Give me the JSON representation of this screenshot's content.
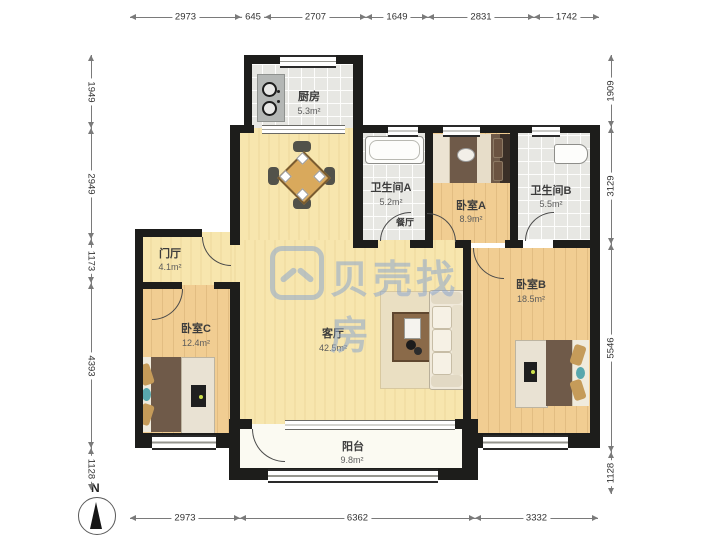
{
  "watermark": {
    "brand": "贝壳找房"
  },
  "compass": {
    "label": "N"
  },
  "rooms": {
    "kitchen": {
      "name": "厨房",
      "area": "5.3m²"
    },
    "bathroom_a": {
      "name": "卫生间A",
      "area": "5.2m²"
    },
    "bedroom_a": {
      "name": "卧室A",
      "area": "8.9m²"
    },
    "bathroom_b": {
      "name": "卫生间B",
      "area": "5.5m²"
    },
    "foyer": {
      "name": "门厅",
      "area": "4.1m²"
    },
    "bedroom_c": {
      "name": "卧室C",
      "area": "12.4m²"
    },
    "living_room": {
      "name": "客厅",
      "area": "42.5m²"
    },
    "bedroom_b": {
      "name": "卧室B",
      "area": "18.5m²"
    },
    "balcony": {
      "name": "阳台",
      "area": "9.8m²"
    },
    "dining": {
      "name": "餐厅"
    }
  },
  "dimensions_mm": {
    "top": [
      "2973",
      "645",
      "2707",
      "1649",
      "2831",
      "1742"
    ],
    "left": [
      "1949",
      "2949",
      "1173",
      "4393",
      "1128"
    ],
    "right": [
      "1909",
      "3129",
      "5546",
      "1128"
    ],
    "bottom": [
      "2973",
      "6362",
      "3332"
    ]
  },
  "colors": {
    "wall": "#1d1d1b",
    "wood_floor": "#f1cd92",
    "pale_floor": "#f7e6ae",
    "tile_floor": "#e7e7e3",
    "balcony_floor": "#fbfaf2",
    "watermark": "#8da6ce"
  }
}
